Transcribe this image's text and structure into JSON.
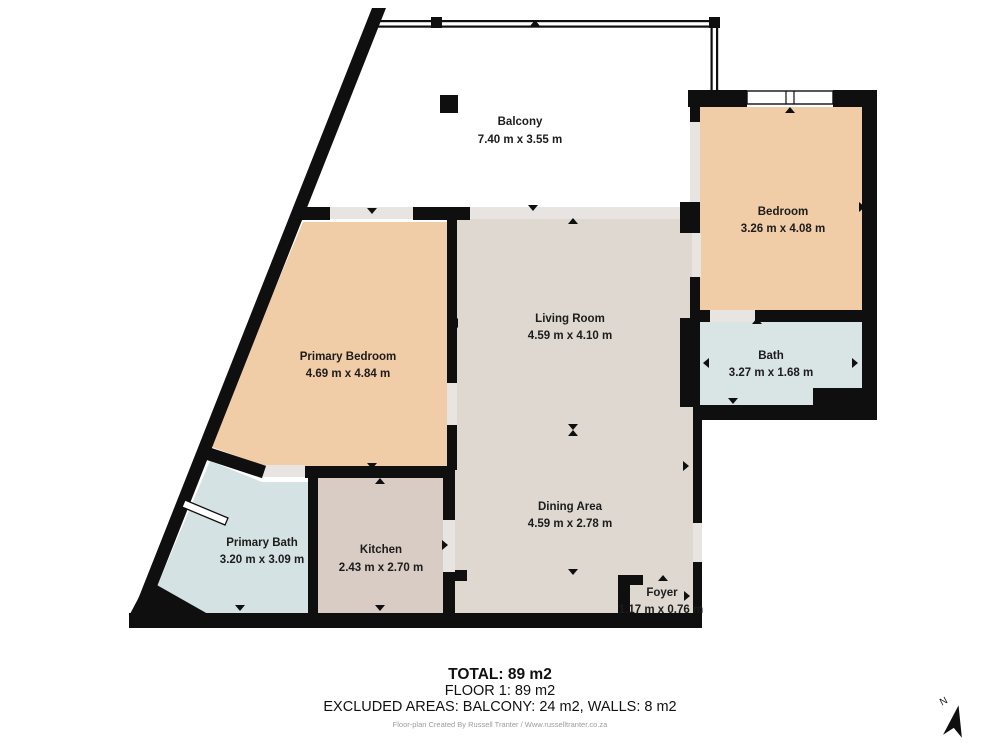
{
  "plan": {
    "rooms": [
      {
        "id": "balcony",
        "name": "Balcony",
        "dims": "7.40 m x 3.55 m"
      },
      {
        "id": "bedroom",
        "name": "Bedroom",
        "dims": "3.26 m x 4.08 m"
      },
      {
        "id": "bath",
        "name": "Bath",
        "dims": "3.27 m x 1.68 m"
      },
      {
        "id": "primary-bedroom",
        "name": "Primary Bedroom",
        "dims": "4.69 m x 4.84 m"
      },
      {
        "id": "living-room",
        "name": "Living Room",
        "dims": "4.59 m x 4.10 m"
      },
      {
        "id": "dining-area",
        "name": "Dining Area",
        "dims": "4.59 m x 2.78 m"
      },
      {
        "id": "primary-bath",
        "name": "Primary Bath",
        "dims": "3.20 m x 3.09 m"
      },
      {
        "id": "kitchen",
        "name": "Kitchen",
        "dims": "2.43 m x 2.70 m"
      },
      {
        "id": "foyer",
        "name": "Foyer",
        "dims": "1.17 m x 0.76 m"
      }
    ]
  },
  "summary": {
    "total": "TOTAL: 89 m2",
    "floor": "FLOOR 1: 89 m2",
    "excluded": "EXCLUDED AREAS: BALCONY: 24 m2, WALLS: 8 m2",
    "credit": "Floor-plan Created By Russell Tranter / Www.russelltranter.co.za"
  },
  "compass": {
    "label": "N"
  },
  "icons": {
    "north_arrow": "north-compass-needle"
  },
  "colors": {
    "wall": "#0f0f0f",
    "bedroom_fill": "#f0cca7",
    "living_fill": "#ded8d0",
    "kitchen_fill": "#d8ccc4",
    "bath_fill": "#d9e4e5",
    "primary_bath_fill": "#d5e2e3",
    "opening_fill": "#e7e4e1",
    "label_text": "#1c1c1c",
    "credit_text": "#9b9b9b",
    "background": "#ffffff"
  }
}
